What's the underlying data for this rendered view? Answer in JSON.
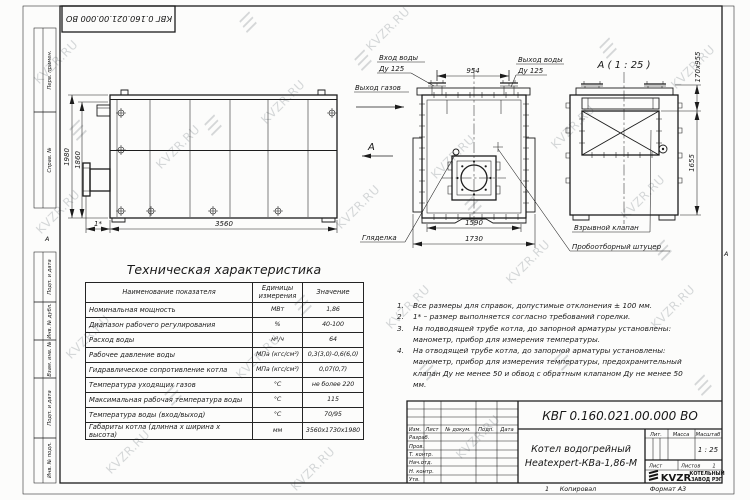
{
  "watermark": {
    "text": "KVZR.RU",
    "logo_glyph": "☰"
  },
  "frame": {
    "top_stamp": "КВГ 0.160.021.00.000 ВО",
    "zone_marker": "А",
    "left_strips": [
      "Перв. примен.",
      "Справ. №",
      "Подп. и дата",
      "Инв. № дубл.",
      "Взам. инв. №",
      "Подп. и дата",
      "Инв. № подл."
    ]
  },
  "views": {
    "side": {
      "dim_height": "1980",
      "dim_height_inner": "1860",
      "dim_length": "3560",
      "dim_burner": "1*"
    },
    "front": {
      "label_water_in_1": "Вход воды",
      "label_water_in_2": "Ду 125",
      "label_water_out_1": "Выход воды",
      "label_water_out_2": "Ду 125",
      "label_gas_out": "Выход газов",
      "view_arrow": "А",
      "dim_top": "954",
      "dim_bottom_inner": "1590",
      "dim_bottom_outer": "1730",
      "label_sight": "Гляделка",
      "label_valve": "Взрывной клапан",
      "label_sampler": "Пробоотборный штуцер"
    },
    "rear": {
      "title": "А ( 1 : 25 )",
      "dim_top": "170х955",
      "dim_side": "1655"
    }
  },
  "table": {
    "title": "Техническая характеристика",
    "headers": [
      "Наименование показателя",
      "Единицы измерения",
      "Значение"
    ],
    "rows": [
      {
        "name": "Номинальная мощность",
        "unit": "МВт",
        "value": "1,86"
      },
      {
        "name": "Диапазон рабочего регулирования",
        "unit": "%",
        "value": "40-100"
      },
      {
        "name": "Расход воды",
        "unit": "м³/ч",
        "value": "64"
      },
      {
        "name": "Рабочее давление воды",
        "unit": "МПа (кгс/см²)",
        "value": "0,3(3,0)-0,6(6,0)"
      },
      {
        "name": "Гидравлическое сопротивление котла",
        "unit": "МПа (кгс/см²)",
        "value": "0,07(0,7)"
      },
      {
        "name": "Температура уходящих газов",
        "unit": "°С",
        "value": "не более 220"
      },
      {
        "name": "Максимальная рабочая температура воды",
        "unit": "°С",
        "value": "115"
      },
      {
        "name": "Температура воды (вход/выход)",
        "unit": "°С",
        "value": "70/95"
      },
      {
        "name": "Габариты котла (длинна х ширина х высота)",
        "unit": "мм",
        "value": "3560х1730х1980"
      }
    ]
  },
  "notes": {
    "items": [
      {
        "num": "1.",
        "text": "Все размеры для справок, допустимые отклонения ± 100 мм."
      },
      {
        "num": "2.",
        "text": "1* – размер выполняется согласно требований горелки."
      },
      {
        "num": "3.",
        "text": "На подводящей трубе котла, до запорной арматуры установлены: манометр, прибор для измерения температуры."
      },
      {
        "num": "4.",
        "text": "На отводящей трубе котла, до запорной арматуры установлены: манометр, прибор для измерения температуры, предохранительный клапан Ду не менее 50 и обвод с обратным клапаном Ду не менее 50 мм."
      }
    ]
  },
  "title_block": {
    "doc_number": "КВГ 0.160.021.00.000 ВО",
    "product_name_1": "Котел водогрейный",
    "product_name_2": "Heatexpert-КВа-1,86-М",
    "header_cols": [
      "Изм.",
      "Лист",
      "№ докум.",
      "Подп.",
      "Дата"
    ],
    "row_labels": [
      "Разраб.",
      "Пров.",
      "Т. контр.",
      "Нач.отд.",
      "Н. контр.",
      "Утв."
    ],
    "lit_label": "Лит.",
    "mass_label": "Масса",
    "scale_label": "Масштаб",
    "scale_value": "1 : 25",
    "sheet_label": "Лист",
    "sheets_label": "Листов",
    "sheets_value": "1",
    "logo_text": "KVZR",
    "logo_sub_1": "КОТЕЛЬНЫЙ",
    "logo_sub_2": "ЗАВОД РЭП",
    "copy_num": "1",
    "copied_label": "Копировал",
    "format_label": "Формат А3"
  }
}
